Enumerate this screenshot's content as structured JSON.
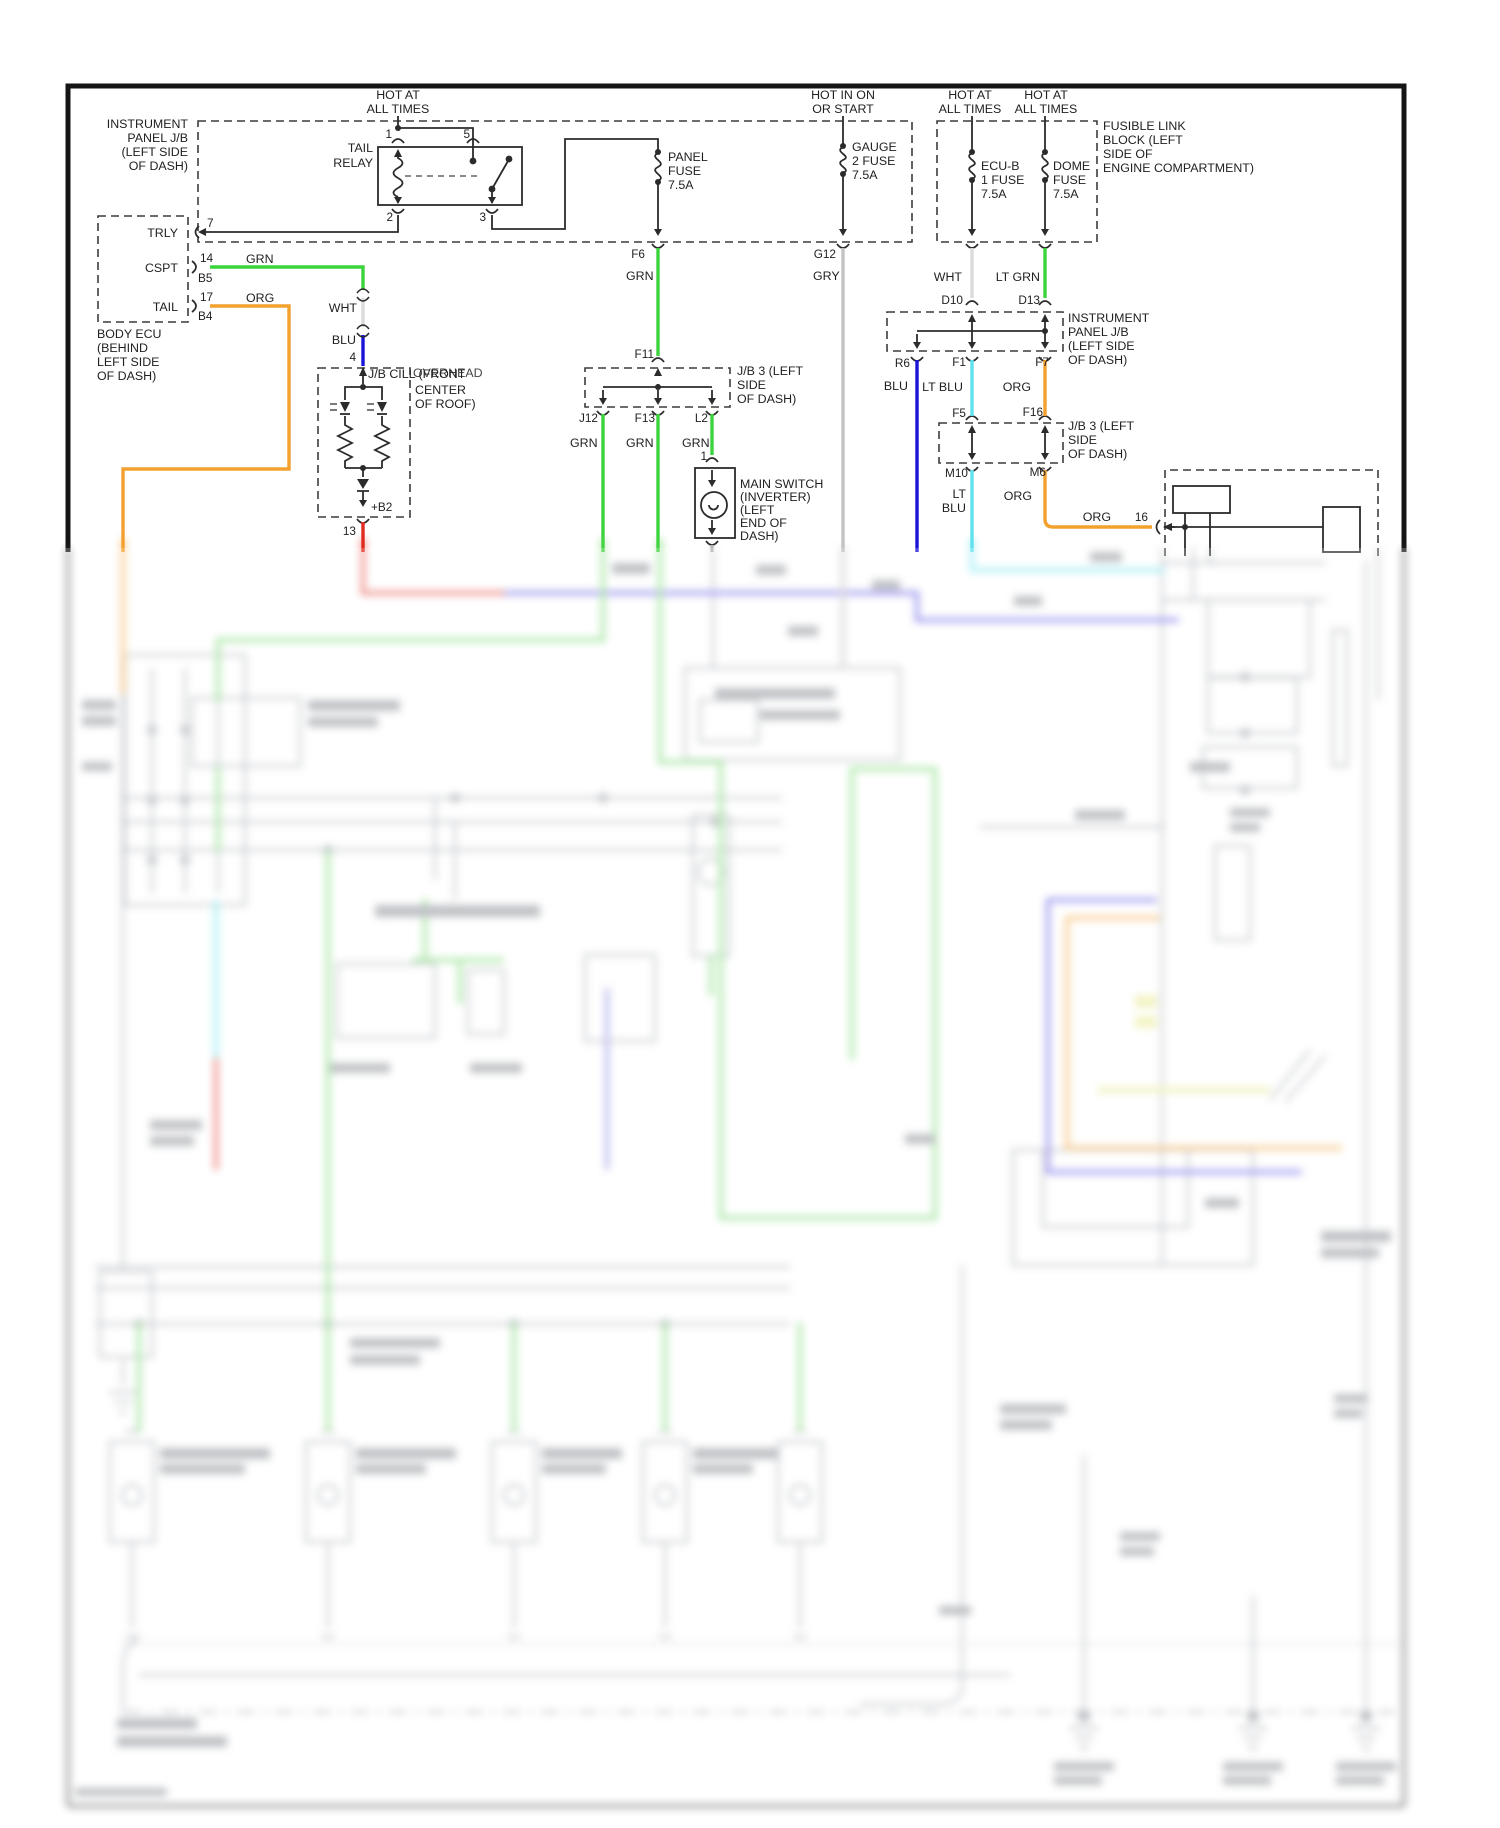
{
  "diagram": {
    "power_feeds": {
      "hot_at": "HOT AT",
      "all_times": "ALL TIMES",
      "hot_in_on": "HOT IN ON",
      "or_start": "OR START"
    },
    "wire_colors": {
      "grn": "GRN",
      "org": "ORG",
      "wht": "WHT",
      "blu": "BLU",
      "gry": "GRY",
      "lt_grn": "LT GRN",
      "lt_blu": "LT BLU",
      "lt": "LT"
    },
    "labels": {
      "instrument_panel_jb": [
        "INSTRUMENT",
        "PANEL J/B",
        "(LEFT SIDE",
        "OF DASH)"
      ],
      "tail_relay": [
        "TAIL",
        "RELAY"
      ],
      "panel_fuse": [
        "PANEL",
        "FUSE",
        "7.5A"
      ],
      "gauge_fuse": [
        "GAUGE",
        "2 FUSE",
        "7.5A"
      ],
      "ecu_b_fuse": [
        "ECU-B",
        "1 FUSE",
        "7.5A"
      ],
      "dome_fuse": [
        "DOME",
        "FUSE",
        "7.5A"
      ],
      "fusible_link": [
        "FUSIBLE LINK",
        "BLOCK (LEFT",
        "SIDE OF",
        "ENGINE COMPARTMENT)"
      ],
      "body_ecu": [
        "BODY ECU",
        "(BEHIND",
        "LEFT SIDE",
        "OF DASH)"
      ],
      "body_ecu_terminals": [
        "TRLY",
        "CSPT",
        "TAIL"
      ],
      "jb_cill": {
        "name": "J/B CILL (FRONT",
        "overlay": "OVERHEAD",
        "line2": "CENTER",
        "line3": "OF ROOF)"
      },
      "jb3": [
        "J/B 3 (LEFT",
        "SIDE",
        "OF DASH)"
      ],
      "main_switch": [
        "MAIN SWITCH",
        "(INVERTER)",
        "(LEFT",
        "END OF",
        "DASH)"
      ]
    },
    "terminals": {
      "t1": "1",
      "t2": "2",
      "t3": "3",
      "t5": "5",
      "t7": "7",
      "t13": "13",
      "t14": "14",
      "t16": "16",
      "t17": "17",
      "b5": "B5",
      "b4": "B4",
      "plus_b2": "+B2",
      "t4": "4",
      "f6": "F6",
      "g12": "G12",
      "f11": "F11",
      "j12": "J12",
      "f13": "F13",
      "l2": "L2",
      "d10": "D10",
      "d13": "D13",
      "r6": "R6",
      "f1": "F1",
      "f7": "F7",
      "f5": "F5",
      "f16": "F16",
      "m10": "M10",
      "m6": "M6",
      "sw1": "1"
    },
    "colors": {
      "green": "#3CD43C",
      "orange": "#F2A02E",
      "red": "#E02B20",
      "blue": "#1B13D8",
      "cyan": "#5FE2EE",
      "gray_wire": "#C3C3C3",
      "white_wire": "#DCDCDC",
      "yellow": "#F0F0A0",
      "line": "#2B2B2B"
    }
  }
}
